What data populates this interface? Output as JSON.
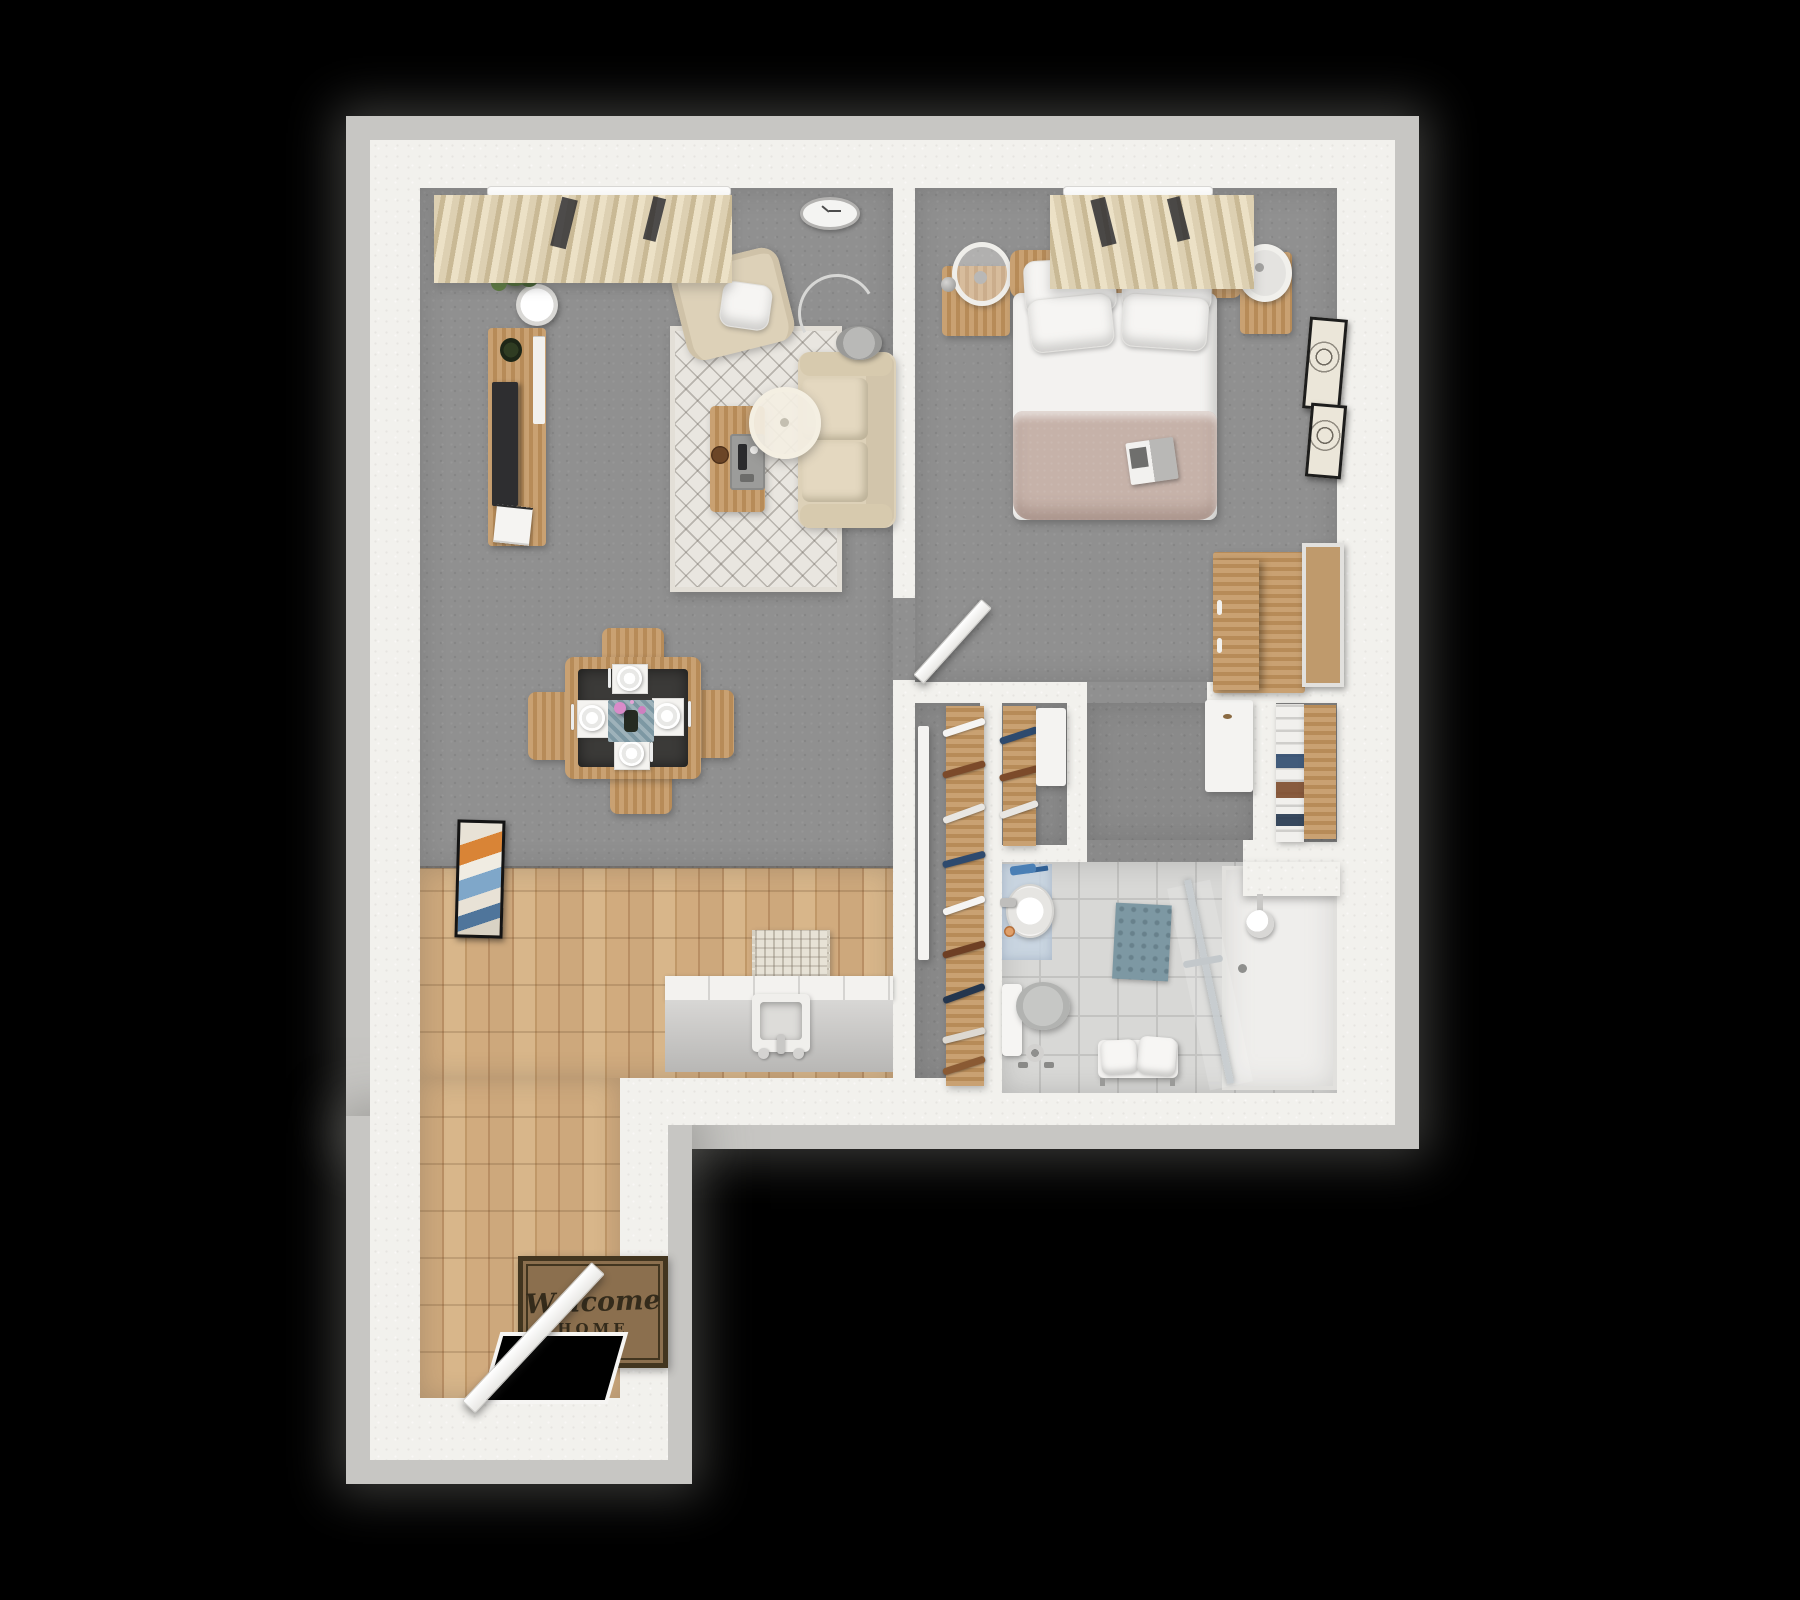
{
  "scene_type": "3d-floor-plan-top-view",
  "welcome_mat": {
    "line1": "Welcome",
    "line2": "HOME"
  },
  "palette": {
    "black": "#000000",
    "fringe": "#c7c6c3",
    "wall": "#f2f1ed",
    "carpet": "#909090",
    "carpetDark": "#8a8a8a",
    "woodFloorA": "#cda87c",
    "woodFloorB": "#b98f64",
    "woodFloorC": "#d8b68a",
    "woodFurn": "#c2945e",
    "beigeSofa": "#ddd1b8",
    "rugBase": "#e9e6e0",
    "duvet": "#c6b2a9",
    "white": "#f4f3f1",
    "tvDark": "#2e2e30",
    "tile": "#d8d8d6",
    "tileLine": "#c3c3c1",
    "showerWhite": "#efeeec",
    "teal": "#7d98a3",
    "bathBlue": "#c7d5e3",
    "matBrown": "#8b6f4e",
    "matBorder": "#42351f",
    "matText": "#342b1b",
    "curtain": "#ddd0b2",
    "curtainDark": "#c9b995",
    "tableDark": "#3b3a38",
    "plantGreen": "#4c6a33"
  },
  "rooms": [
    {
      "name": "living-room",
      "flooring": "gray-carpet",
      "items": [
        "window-curtains",
        "curtain-rail",
        "potted-plant",
        "plant-stand",
        "tv-sideboard",
        "television",
        "small-plant",
        "magazines",
        "wall-clock",
        "armchair",
        "throw-pillow",
        "area-rug",
        "sofa",
        "coffee-table",
        "serving-tray",
        "coaster",
        "drum-floor-lamp",
        "arc-floor-lamp"
      ]
    },
    {
      "name": "dining-area",
      "flooring": "gray-carpet",
      "items": [
        "square-dining-table",
        "four-chairs",
        "four-place-settings",
        "table-runner",
        "flower-vase"
      ]
    },
    {
      "name": "kitchen",
      "flooring": "wood-plank",
      "items": [
        "counter-with-cabinets",
        "square-sink",
        "faucet",
        "runner-mat"
      ]
    },
    {
      "name": "entry",
      "flooring": "wood-plank",
      "items": [
        "welcome-mat",
        "open-front-door",
        "wall-art"
      ]
    },
    {
      "name": "bedroom",
      "flooring": "gray-carpet",
      "items": [
        "double-bed",
        "headboard",
        "four-pillows",
        "duvet",
        "magazine",
        "nightstand-left",
        "ring-table-lamp",
        "nightstand-right",
        "table-fan",
        "window-curtains",
        "wardrobe",
        "leaning-mirror",
        "two-wall-frames",
        "open-door"
      ]
    },
    {
      "name": "closet-hall",
      "flooring": "gray-carpet",
      "items": [
        "sliding-door-closet",
        "clothes-rail-left",
        "clothes-rail-right",
        "closet-cabinet",
        "white-dresser",
        "slatted-shelf-unit",
        "wood-side-panel"
      ]
    },
    {
      "name": "bathroom",
      "flooring": "tile",
      "items": [
        "vanity-sink",
        "blue-bath-mat",
        "accessories",
        "toilet",
        "toilet-paper-stand",
        "towel-bench",
        "teal-mat",
        "walk-in-shower",
        "glass-panel",
        "grab-bar",
        "shower-head",
        "floor-drain"
      ]
    }
  ]
}
